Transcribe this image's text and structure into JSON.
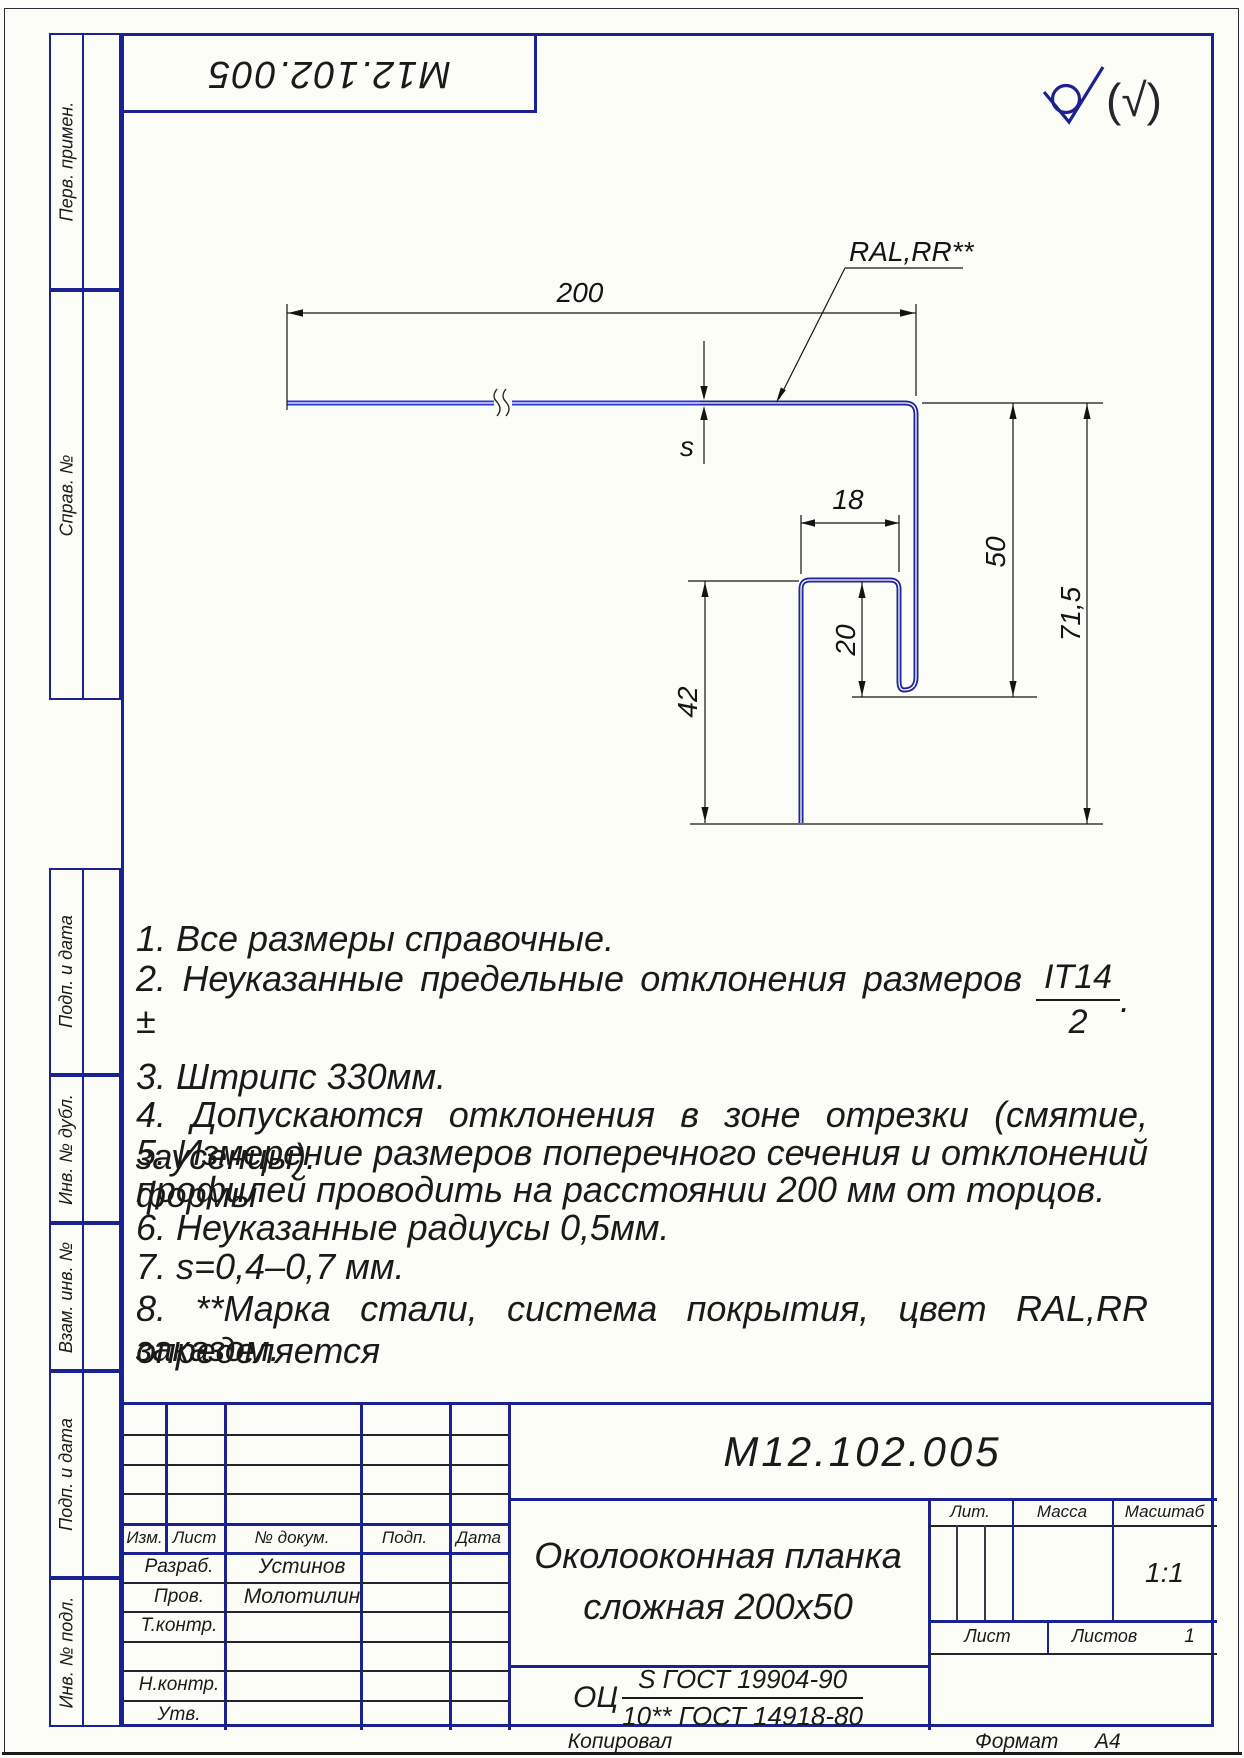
{
  "colors": {
    "frame_blue": "#1b2290",
    "profile_dark": "#20269a",
    "profile_bright": "#2c38d2",
    "ink": "#141414"
  },
  "top_stamp": {
    "code": "М12.102.005"
  },
  "roughness": {
    "note": "(√)"
  },
  "margin_labels": [
    "Перв. примен.",
    "Справ. №",
    "Подп. и дата",
    "Инв. № дубл.",
    "Взам. инв. №",
    "Подп. и дата",
    "Инв. № подл."
  ],
  "drawing": {
    "leader_label": "RAL,RR**",
    "dim_width": "200",
    "dim_thickness": "s",
    "dim_lip": "18",
    "dim_leg": "50",
    "dim_total_height": "71,5",
    "dim_return": "20",
    "dim_inner_leg": "42"
  },
  "notes": {
    "n1": "1.  Все размеры справочные.",
    "n2_text": "2.  Неуказанные предельные отклонения размеров ±",
    "n2_frac_num": "IT14",
    "n2_frac_den": "2",
    "n2_end": ".",
    "n3": "3.  Штрипс 330мм.",
    "n4": "4.  Допускаются отклонения в зоне отрезки (смятие, заусенцы).",
    "n5_line1": "5.  Измерение размеров поперечного сечения и отклонений формы",
    "n5_line2": "профилей проводить на расстоянии 200 мм от торцов.",
    "n6": "6.  Неуказанные радиусы 0,5мм.",
    "n7": "7.  s=0,4–0,7 мм.",
    "n8_line1": "8.  **Марка стали, система покрытия, цвет RAL,RR определяется",
    "n8_line2": "заказом."
  },
  "title_block": {
    "designation": "М12.102.005",
    "name_line1": "Околооконная планка",
    "name_line2": "сложная 200х50",
    "material_prefix": "ОЦ",
    "material_num": "S ГОСТ 19904-90",
    "material_den": "10** ГОСТ 14918-80",
    "headers": {
      "izm": "Изм.",
      "list": "Лист",
      "doc": "№ докум.",
      "podp": "Подп.",
      "data": "Дата",
      "lit": "Лит.",
      "massa": "Масса",
      "masshtab": "Масштаб",
      "list2": "Лист",
      "listov": "Листов"
    },
    "scale": "1:1",
    "sheets_value": "1",
    "roles": [
      {
        "role": "Разраб.",
        "name": "Устинов"
      },
      {
        "role": "Пров.",
        "name": "Молотилин"
      },
      {
        "role": "Т.контр.",
        "name": ""
      },
      {
        "role": "",
        "name": ""
      },
      {
        "role": "Н.контр.",
        "name": ""
      },
      {
        "role": "Утв.",
        "name": ""
      }
    ]
  },
  "footer": {
    "copied": "Копировал",
    "format_label": "Формат",
    "format_value": "А4"
  }
}
